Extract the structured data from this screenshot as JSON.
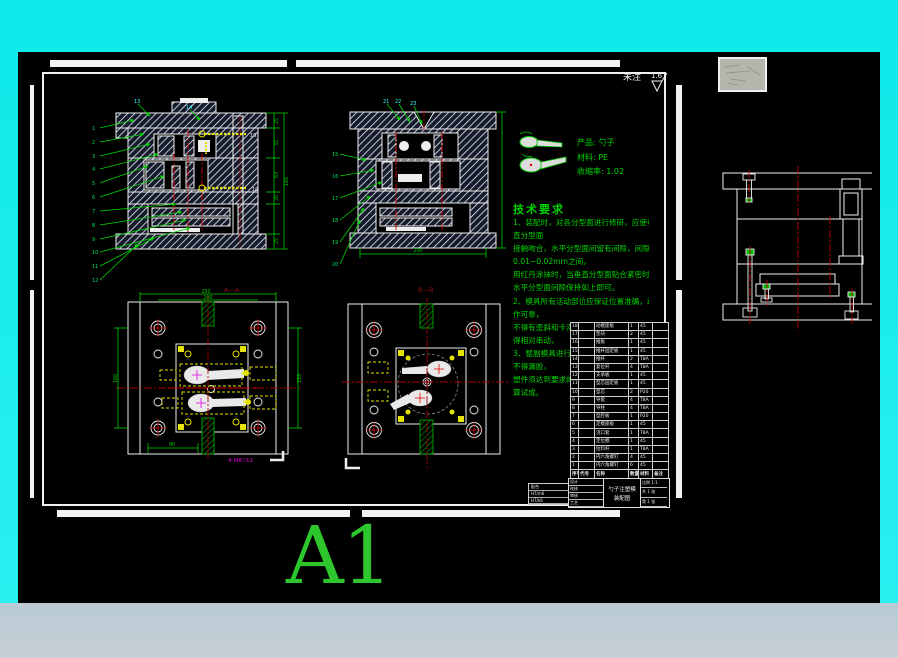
{
  "colors": {
    "background": "#0de9e9",
    "background2": "#2cf0f0",
    "bottom_strip": "#c0cdd5",
    "canvas": "#000000",
    "line_white": "#f2f2f2",
    "cad_green": "#00d400",
    "cad_cyan": "#35ffff",
    "cad_red": "#d40000",
    "dark_red": "#8f1010",
    "cad_yellow": "#e3e300",
    "cad_magenta": "#e200e2",
    "hatch_bg": "#151b2a",
    "a1_green": "#2dc62d",
    "thumb_gray": "#b5b5ad"
  },
  "sheet": {
    "format_label": "A1"
  },
  "surface_note": {
    "prefix": "未注",
    "roughness": "1.6"
  },
  "product_info": {
    "lines": "产品: 勺子\n材料: PE\n收缩率: 1.02"
  },
  "tech_requirements": {
    "title": "技术要求",
    "lines": [
      "1、装配时，对各分型面进行修研，应使垂",
      "直分型面",
      "接触吻合，水平分型面间留有间隙，间隙在",
      "0.01~0.02mm之间，",
      "用红丹涂抹时，当垂直分型面贴合紧密时，",
      "水平分型面间隙保持如上即可。",
      "2、模具所有活动部位应保证位置准确，动",
      "作可靠，",
      "不得有歪斜和卡滞现象，要求固定的零件不",
      "得相对串动，",
      "3、整副模具进行试模验收，达到设计要求",
      "不得漏胶，",
      "塑件须达到要求的尺寸精度，表面质量，方",
      "算试成。"
    ]
  },
  "views": {
    "section_a": {
      "label": "A—A",
      "leaders": [
        "1",
        "2",
        "3",
        "4",
        "5",
        "6",
        "7",
        "8",
        "9",
        "10",
        "11",
        "12"
      ],
      "top_balloons": [
        "13",
        "14"
      ],
      "screw_labels": [
        "10",
        "10"
      ],
      "dims": [
        "25",
        "32",
        "63",
        "20",
        "25"
      ],
      "dim_overall": "165"
    },
    "section_b": {
      "label": "B—B",
      "leaders": [
        "15",
        "16",
        "17",
        "18",
        "19",
        "20"
      ],
      "top_balloons": [
        "21",
        "22",
        "23"
      ],
      "dim_bottom": "200"
    },
    "plan_cavity": {
      "dim_top": "250",
      "dim_inner": "200",
      "dim_left": "160",
      "dim_right": "155",
      "dim_bottom": "90",
      "thread_note": "4-M8▽12"
    }
  },
  "bom": {
    "headers": [
      "序号",
      "代号",
      "名称",
      "数量",
      "材料",
      "备注"
    ],
    "rows": [
      [
        "18",
        "",
        "动模座板",
        "1",
        "45",
        ""
      ],
      [
        "17",
        "",
        "垫块",
        "2",
        "45",
        ""
      ],
      [
        "16",
        "",
        "推板",
        "1",
        "45",
        ""
      ],
      [
        "15",
        "",
        "推杆固定板",
        "1",
        "45",
        ""
      ],
      [
        "14",
        "",
        "推杆",
        "2",
        "T8A",
        ""
      ],
      [
        "13",
        "",
        "复位杆",
        "4",
        "T8A",
        ""
      ],
      [
        "12",
        "",
        "支承板",
        "1",
        "45",
        ""
      ],
      [
        "11",
        "",
        "型芯固定板",
        "1",
        "45",
        ""
      ],
      [
        "10",
        "",
        "型芯",
        "2",
        "P20",
        ""
      ],
      [
        "9",
        "",
        "导套",
        "4",
        "T8A",
        ""
      ],
      [
        "8",
        "",
        "导柱",
        "4",
        "T8A",
        ""
      ],
      [
        "7",
        "",
        "型腔板",
        "1",
        "P20",
        ""
      ],
      [
        "6",
        "",
        "定模座板",
        "1",
        "45",
        ""
      ],
      [
        "5",
        "",
        "浇口套",
        "1",
        "T8A",
        ""
      ],
      [
        "4",
        "",
        "定位圈",
        "1",
        "45",
        ""
      ],
      [
        "3",
        "",
        "拉料杆",
        "1",
        "T8A",
        ""
      ],
      [
        "2",
        "",
        "内六角螺钉",
        "4",
        "45",
        ""
      ],
      [
        "1",
        "",
        "内六角螺钉",
        "6",
        "45",
        ""
      ]
    ]
  },
  "title_block": {
    "labels": [
      "设计",
      "校核",
      "审核",
      "工艺"
    ],
    "title": "勺子注塑模",
    "subtitle": "装配图",
    "scale": "比例 1:1",
    "sheets": "共 1 张",
    "sheet_no": "第 1 张"
  },
  "fit_table": {
    "title": "配合",
    "rows": [
      "H7/m6",
      "H7/k6"
    ]
  }
}
